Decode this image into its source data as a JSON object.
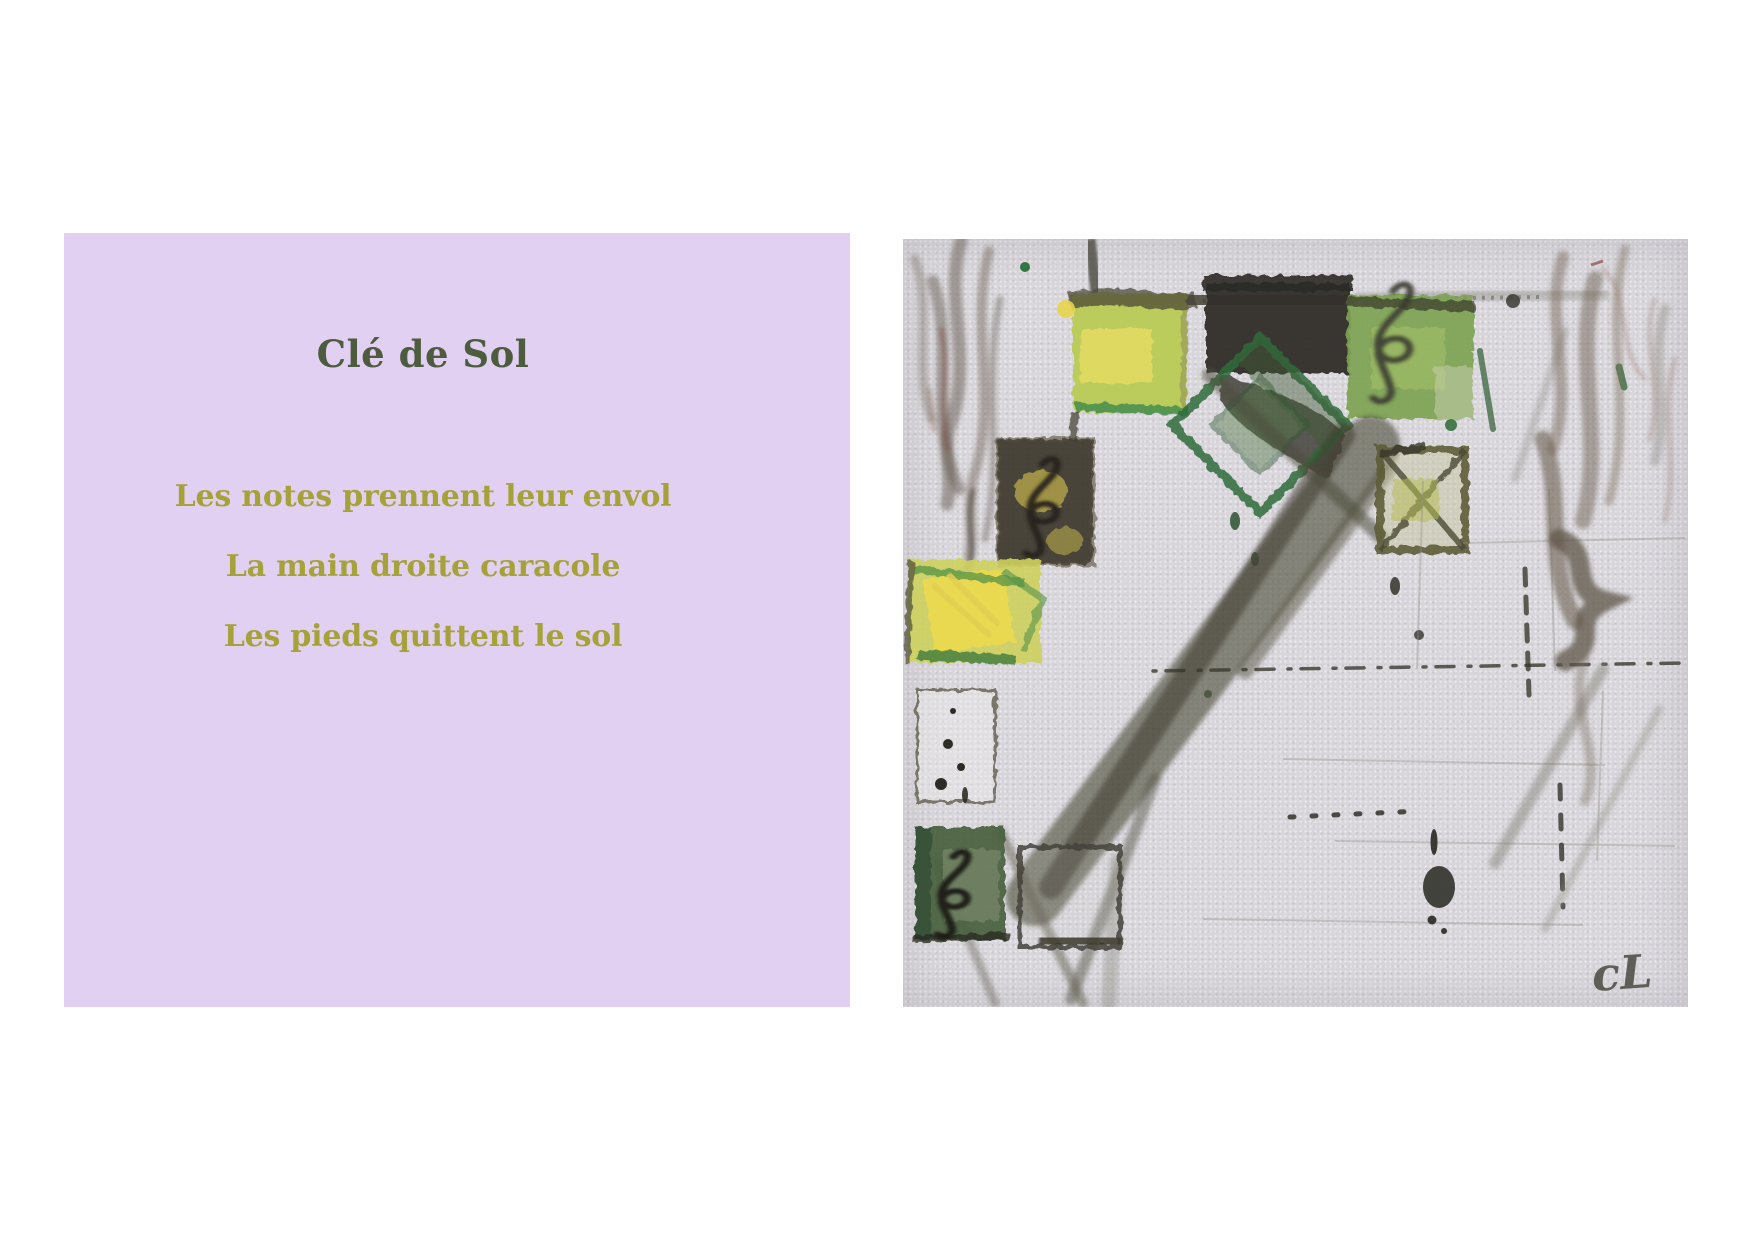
{
  "page": {
    "width": 1754,
    "height": 1241,
    "background": "#ffffff"
  },
  "poem_panel": {
    "background": "#e2d0f3",
    "title": "Clé de Sol",
    "title_color": "#4d5c3d",
    "line_color": "#a6a23a",
    "lines": [
      "Les notes prennent leur envol",
      "La main droite caracole",
      "Les pieds quittent le sol"
    ]
  },
  "painting": {
    "alt": "Abstract acrylic painting: green and yellow squares with treble clefs, dark olive diagonal brushstrokes and brown scribbles on pale canvas",
    "signature": "cL",
    "canvas_color": "#d8d6db",
    "palette": {
      "yellow_green": "#b9cb55",
      "yellow": "#e4da60",
      "green": "#7da352",
      "dark_green": "#2e6b3a",
      "dark_olive": "#33302a",
      "brown": "#6e6054"
    }
  }
}
